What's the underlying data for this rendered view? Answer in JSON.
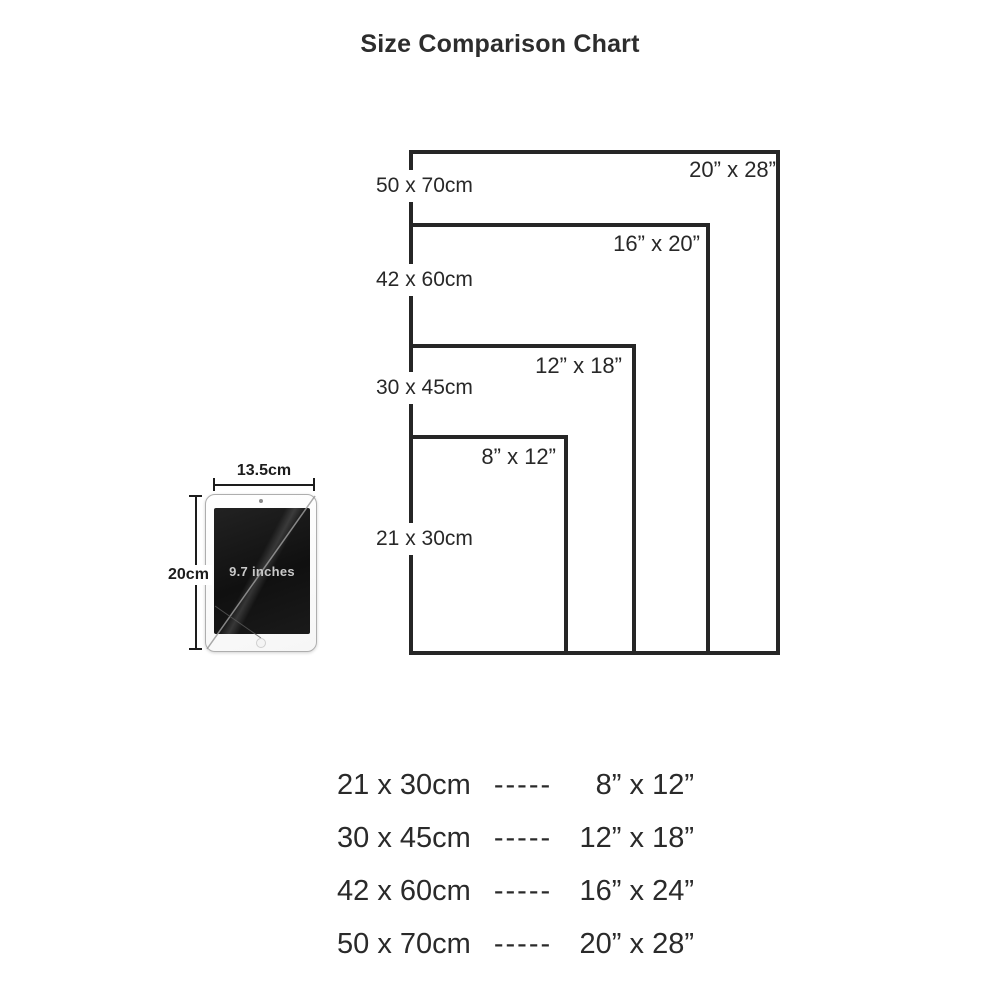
{
  "title": "Size Comparison Chart",
  "colors": {
    "ink": "#262626",
    "background": "#ffffff"
  },
  "chart": {
    "rectangles": [
      {
        "cm": "50 x 70cm",
        "inches": "20” x 28”"
      },
      {
        "cm": "42 x 60cm",
        "inches": "16” x 20”"
      },
      {
        "cm": "30 x 45cm",
        "inches": "12” x 18”"
      },
      {
        "cm": "21 x 30cm",
        "inches": "8” x 12”"
      }
    ]
  },
  "tablet": {
    "width_label": "13.5cm",
    "height_label": "20cm",
    "screen_label": "9.7 inches"
  },
  "legend": {
    "rows": [
      {
        "cm": "21 x 30cm",
        "dashes": "-----",
        "inches": "8” x 12”"
      },
      {
        "cm": "30 x 45cm",
        "dashes": "-----",
        "inches": "12” x 18”"
      },
      {
        "cm": "42 x 60cm",
        "dashes": "-----",
        "inches": "16” x 24”"
      },
      {
        "cm": "50 x 70cm",
        "dashes": "-----",
        "inches": "20” x 28”"
      }
    ]
  }
}
